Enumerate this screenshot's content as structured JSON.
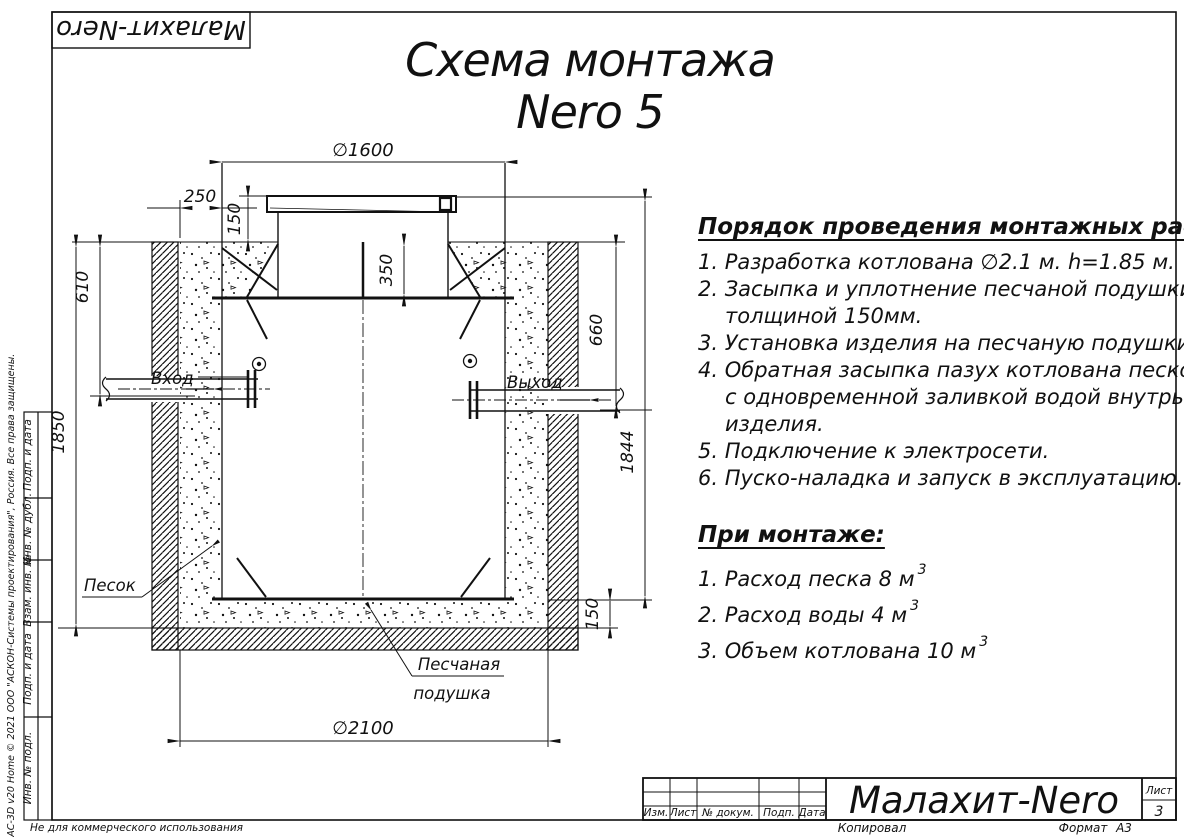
{
  "logo": {
    "text": "Малахит-Nero"
  },
  "title": {
    "line1": "Схема монтажа",
    "line2": "Nero 5"
  },
  "instructions": {
    "heading": "Порядок проведения монтажных работ:",
    "lines": [
      "1. Разработка котлована ∅2.1 м. h=1.85 м.",
      "2. Засыпка и уплотнение песчаной подушки",
      "толщиной 150мм.",
      "3. Установка изделия на песчаную подушки.",
      "4. Обратная засыпка пазух котлована песком,",
      "с одновременной заливкой водой внутрь",
      "изделия.",
      "5. Подключение к электросети.",
      "6. Пуско-наладка и запуск в эксплуатацию."
    ]
  },
  "montage": {
    "heading": "При монтаже:",
    "items": [
      {
        "text": "1. Расход песка 8 м",
        "sup": "3"
      },
      {
        "text": "2. Расход воды 4 м",
        "sup": "3"
      },
      {
        "text": "3. Объем котлована 10 м",
        "sup": "3"
      }
    ]
  },
  "drawing": {
    "dims": {
      "d1600": "∅1600",
      "d250": "250",
      "d150top": "150",
      "d350": "350",
      "d610": "610",
      "d1850": "1850",
      "d660": "660",
      "d1844": "1844",
      "d150bot": "150",
      "d2100": "∅2100"
    },
    "labels": {
      "inlet": "Вход",
      "outlet": "Выход",
      "sand": "Песок",
      "cushion1": "Песчаная",
      "cushion2": "подушка"
    }
  },
  "title_block": {
    "cols": [
      "Изм.",
      "Лист",
      "№ докум.",
      "Подп.",
      "Дата"
    ],
    "name": "Малахит-Nero",
    "sheet_label": "Лист",
    "sheet_number": "3",
    "copied": "Копировал",
    "format_label": "Формат",
    "format_value": "А3"
  },
  "side_stamp": {
    "cells": [
      "Подп. и дата",
      "Инв. № дубл.",
      "Взам. инв. №",
      "Подп. и дата",
      "Инв. № подл."
    ],
    "kompas": "КОМПАС-3D v20 Home © 2021 ООО \"АСКОН-Системы проектирования\", Россия. Все права защищены.",
    "not_commercial": "Не для коммерческого использования"
  },
  "colors": {
    "ink": "#111111",
    "paper": "#ffffff"
  }
}
